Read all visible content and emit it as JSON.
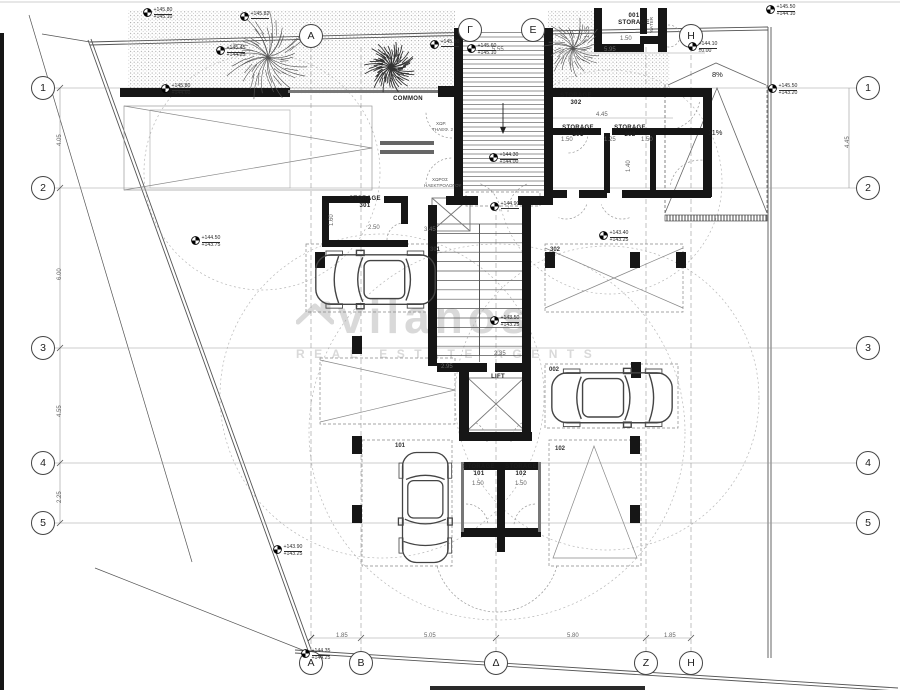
{
  "watermark": {
    "brand": "vilanos",
    "subtitle": "REAL ESTATE AGENTS"
  },
  "grid": {
    "left_x": 43,
    "right_x": 868,
    "bottom_y": 663,
    "side_rows": [
      {
        "label": "1",
        "y": 88
      },
      {
        "label": "2",
        "y": 188
      },
      {
        "label": "3",
        "y": 348
      },
      {
        "label": "4",
        "y": 463
      },
      {
        "label": "5",
        "y": 523
      }
    ],
    "bottom_cols": [
      {
        "label": "A",
        "x": 311
      },
      {
        "label": "B",
        "x": 361
      },
      {
        "label": "Δ",
        "x": 496
      },
      {
        "label": "Z",
        "x": 646
      },
      {
        "label": "H",
        "x": 691
      }
    ],
    "top_cols": [
      {
        "label": "A",
        "x": 311,
        "y": 36
      },
      {
        "label": "Γ",
        "x": 470,
        "y": 30
      },
      {
        "label": "Ε",
        "x": 533,
        "y": 30
      },
      {
        "label": "H",
        "x": 691,
        "y": 36
      }
    ]
  },
  "room_labels": [
    {
      "name": "common",
      "lines": [
        "COMMON"
      ],
      "x": 408,
      "y": 96
    },
    {
      "name": "storage-302",
      "lines": [
        "STORAGE",
        "302"
      ],
      "x": 576,
      "y": 93
    },
    {
      "name": "storage-201",
      "lines": [
        "STORAGE",
        "201"
      ],
      "x": 578,
      "y": 125
    },
    {
      "name": "storage-202",
      "lines": [
        "STORAGE",
        "202"
      ],
      "x": 630,
      "y": 125
    },
    {
      "name": "storage-301",
      "lines": [
        "STORAGE",
        "301"
      ],
      "x": 365,
      "y": 196
    },
    {
      "name": "storage-001",
      "lines": [
        "001",
        "STORAGE"
      ],
      "x": 634,
      "y": 13
    },
    {
      "name": "storage-101",
      "lines": [
        "STORAGE",
        "101"
      ],
      "x": 479,
      "y": 464
    },
    {
      "name": "storage-102",
      "lines": [
        "STORAGE",
        "102"
      ],
      "x": 521,
      "y": 464
    },
    {
      "name": "lift",
      "lines": [
        "LIFT"
      ],
      "x": 498,
      "y": 374
    }
  ],
  "parking_labels": [
    {
      "t": "301",
      "x": 430,
      "y": 247
    },
    {
      "t": "302",
      "x": 550,
      "y": 247
    },
    {
      "t": "002",
      "x": 549,
      "y": 367
    },
    {
      "t": "101",
      "x": 395,
      "y": 443
    },
    {
      "t": "102",
      "x": 555,
      "y": 446
    }
  ],
  "dimensions": [
    {
      "t": "1.85",
      "x": 336,
      "y": 633
    },
    {
      "t": "5.05",
      "x": 424,
      "y": 633
    },
    {
      "t": "5.80",
      "x": 567,
      "y": 633
    },
    {
      "t": "1.85",
      "x": 664,
      "y": 633
    },
    {
      "t": "4.05",
      "x": 57,
      "y": 146,
      "v": 1
    },
    {
      "t": "6.00",
      "x": 57,
      "y": 280,
      "v": 1
    },
    {
      "t": "4.55",
      "x": 57,
      "y": 417,
      "v": 1
    },
    {
      "t": "2.25",
      "x": 57,
      "y": 503,
      "v": 1
    },
    {
      "t": "4.45",
      "x": 845,
      "y": 148,
      "v": 1
    },
    {
      "t": "5.55",
      "x": 492,
      "y": 47
    },
    {
      "t": "5.95",
      "x": 604,
      "y": 47
    },
    {
      "t": "1.50",
      "x": 620,
      "y": 36
    },
    {
      "t": "1.35",
      "x": 585,
      "y": 38,
      "v": 1
    },
    {
      "t": "4.45",
      "x": 596,
      "y": 112
    },
    {
      "t": "1.50",
      "x": 561,
      "y": 137
    },
    {
      "t": "1.25",
      "x": 604,
      "y": 137
    },
    {
      "t": "1.50",
      "x": 641,
      "y": 137
    },
    {
      "t": "1.40",
      "x": 626,
      "y": 172,
      "v": 1
    },
    {
      "t": "1.60",
      "x": 329,
      "y": 226,
      "v": 1
    },
    {
      "t": "2.50",
      "x": 368,
      "y": 225
    },
    {
      "t": "3.45",
      "x": 424,
      "y": 227
    },
    {
      "t": "1.50",
      "x": 472,
      "y": 481
    },
    {
      "t": "1.50",
      "x": 515,
      "y": 481
    },
    {
      "t": "2.35",
      "x": 494,
      "y": 351
    },
    {
      "t": "2.95",
      "x": 441,
      "y": 364
    }
  ],
  "elevation_markers": [
    {
      "x": 143,
      "y": 8,
      "l1": "+145.80",
      "l2": "+145.10"
    },
    {
      "x": 240,
      "y": 12,
      "l1": "+145.82",
      "l2": ""
    },
    {
      "x": 216,
      "y": 46,
      "l1": "+145.45",
      "l2": "+144.25"
    },
    {
      "x": 161,
      "y": 84,
      "l1": "+145.80",
      "l2": "+144.60"
    },
    {
      "x": 430,
      "y": 40,
      "l1": "+145.30",
      "l2": ""
    },
    {
      "x": 467,
      "y": 44,
      "l1": "+145.60",
      "l2": "+145.10"
    },
    {
      "x": 489,
      "y": 153,
      "l1": "+144.30",
      "l2": "+144.00"
    },
    {
      "x": 490,
      "y": 202,
      "l1": "+144.90",
      "l2": ""
    },
    {
      "x": 490,
      "y": 316,
      "l1": "+143.50",
      "l2": "+143.25"
    },
    {
      "x": 599,
      "y": 231,
      "l1": "+143.40",
      "l2": "+143.25"
    },
    {
      "x": 766,
      "y": 5,
      "l1": "+145.50",
      "l2": "+144.10"
    },
    {
      "x": 768,
      "y": 84,
      "l1": "+145.50",
      "l2": "+143.20"
    },
    {
      "x": 191,
      "y": 236,
      "l1": "+144.50",
      "l2": "+143.75"
    },
    {
      "x": 273,
      "y": 545,
      "l1": "+143.90",
      "l2": "+143.25"
    },
    {
      "x": 301,
      "y": 649,
      "l1": "+144.35",
      "l2": "+144.25"
    },
    {
      "x": 688,
      "y": 42,
      "l1": "+144.10",
      "l2": "±0.00"
    }
  ],
  "slope_labels": [
    {
      "t": "8%",
      "x": 712,
      "y": 71
    },
    {
      "t": "11%",
      "x": 708,
      "y": 129
    }
  ],
  "small_texts": [
    {
      "t": "ΧΩΡ.",
      "x": 436,
      "y": 121
    },
    {
      "t": "ΤΗΛΕΦ. 2",
      "x": 432,
      "y": 127
    },
    {
      "t": "ΧΩΡΟΣ",
      "x": 432,
      "y": 177
    },
    {
      "t": "ΗΛΕΚΤΡΟΛΟΓΟΥ",
      "x": 424,
      "y": 183
    },
    {
      "t": "WATER",
      "x": 649,
      "y": 33,
      "v": 1
    }
  ]
}
